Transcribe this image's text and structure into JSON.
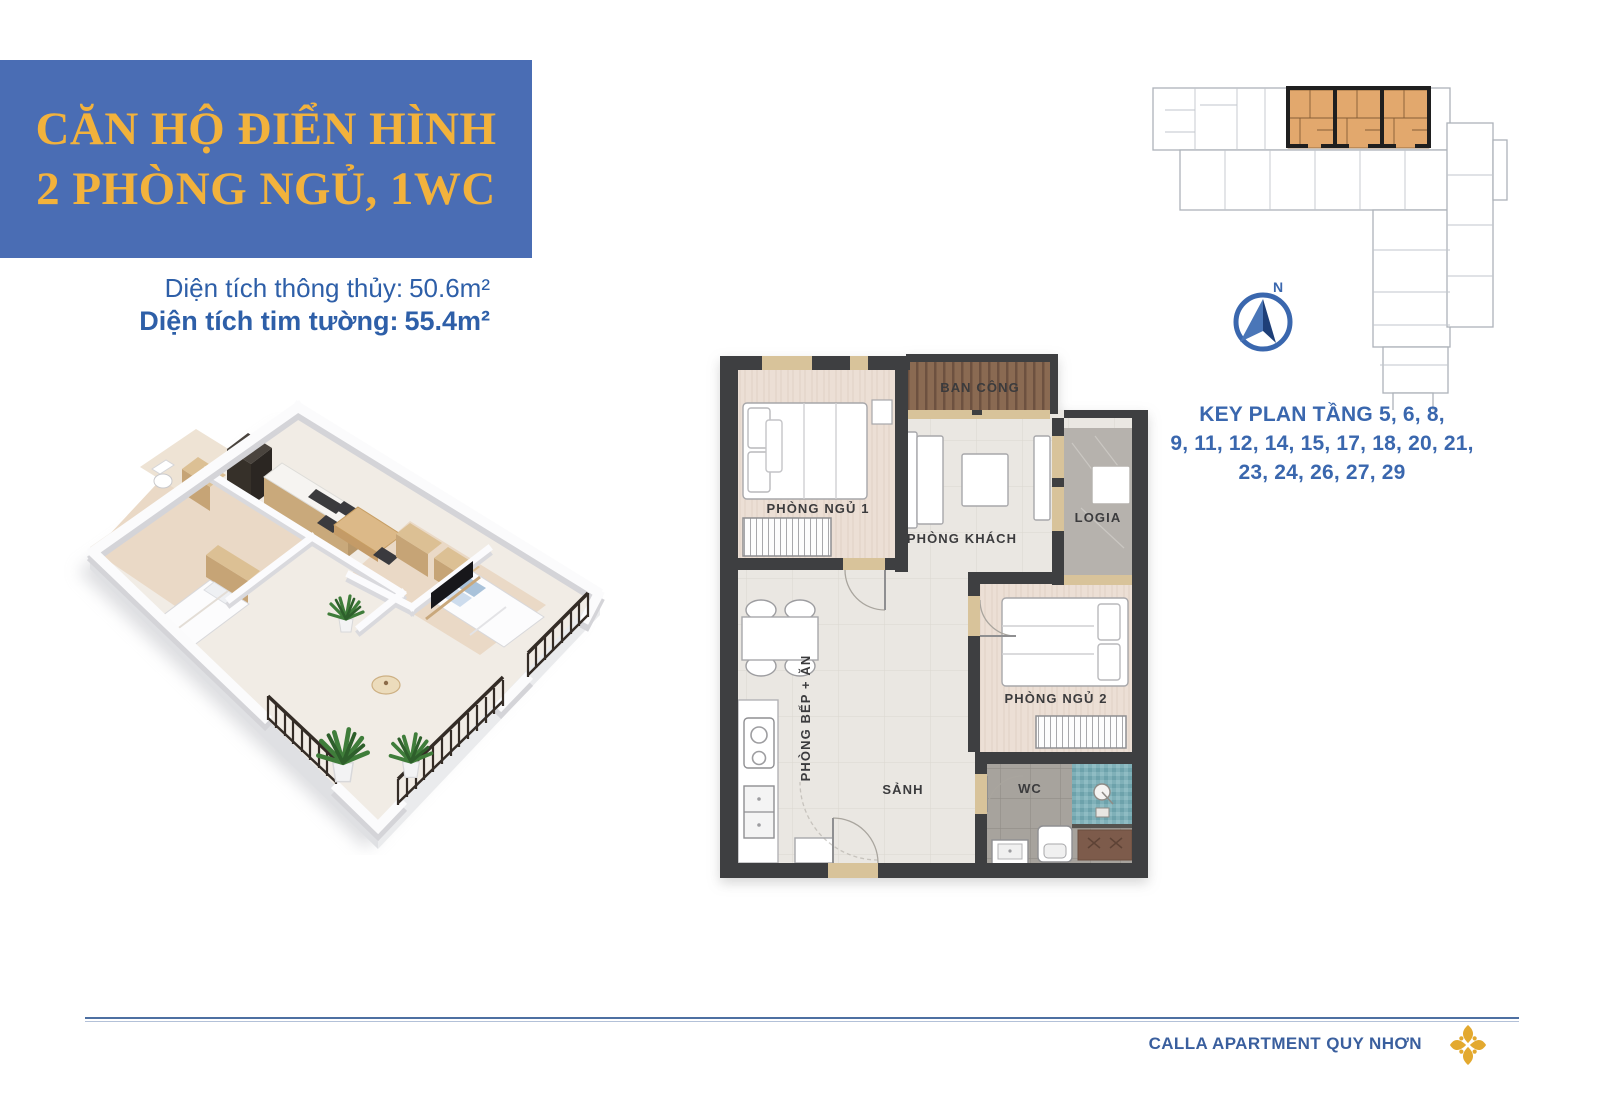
{
  "page": {
    "background": "#ffffff"
  },
  "header": {
    "title_line1": "CĂN HỘ ĐIỂN HÌNH",
    "title_line2": "2 PHÒNG NGỦ, 1WC",
    "bg_color": "#4a6db4",
    "text_color": "#f2b23c"
  },
  "areas": {
    "net_label": "Diện tích thông thủy:",
    "net_value": "50.6m²",
    "gross_label": "Diện tích tim tường:",
    "gross_value": "55.4m²",
    "text_color": "#2e5fa8"
  },
  "key_plan": {
    "caption_line1": "KEY PLAN TẦNG 5, 6, 8,",
    "caption_line2": "9, 11, 12, 14, 15, 17, 18, 20, 21,",
    "caption_line3": "23, 24, 26, 27, 29",
    "north_label": "N",
    "highlight_color": "#e2a86d",
    "caption_color": "#3a67ae"
  },
  "floor_plan": {
    "labels": {
      "ban_cong": "BAN CÔNG",
      "phong_ngu_1": "PHÒNG NGỦ 1",
      "phong_khach": "PHÒNG KHÁCH",
      "logia": "LOGIA",
      "phong_ngu_2": "PHÒNG NGỦ 2",
      "phong_bep_an": "PHÒNG BẾP + ĂN",
      "sanh": "SẢNH",
      "wc": "WC"
    }
  },
  "footer": {
    "brand": "CALLA APARTMENT QUY NHƠN",
    "brand_color": "#3a5f9e",
    "icon_color": "#e3a92f"
  }
}
